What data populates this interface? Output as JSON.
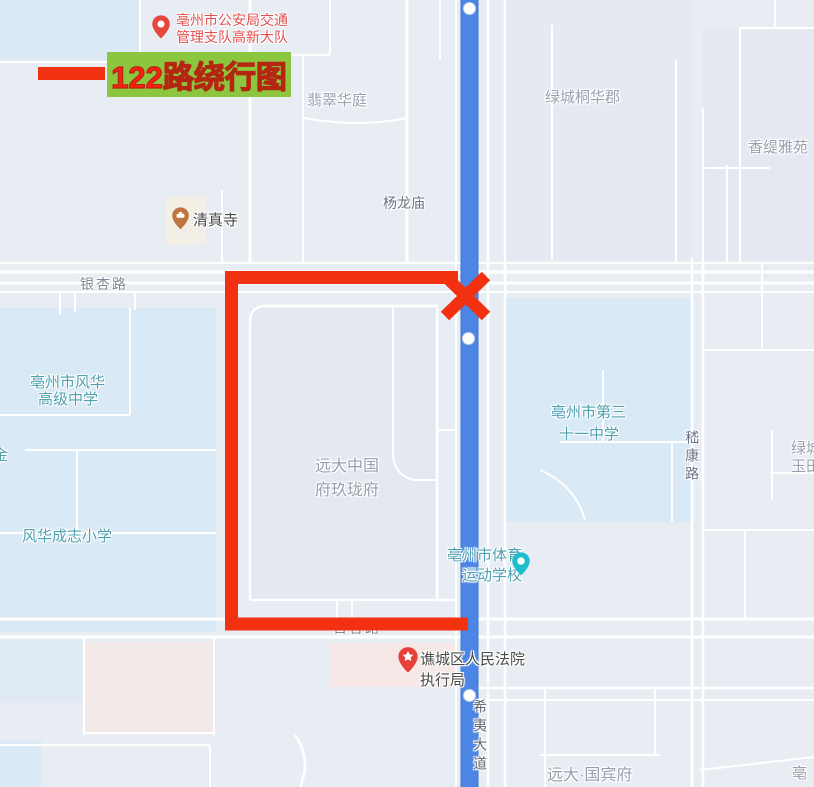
{
  "legend": {
    "title": "122路绕行图"
  },
  "pois": {
    "police": {
      "line1": "亳州市公安局交通",
      "line2": "管理支队高新大队"
    },
    "emerald_court": "翡翠华庭",
    "greentown_tonghua": "绿城桐华郡",
    "chanti_garden": "香缇雅苑",
    "yanglong_temple": "杨龙庙",
    "mosque": "清真寺",
    "fenghua_high": {
      "line1": "亳州市风华",
      "line2": "高级中学"
    },
    "jin_partial": "金",
    "chengzhi_primary": "风华成志小学",
    "yuanda_mansion": {
      "line1": "远大中国",
      "line2": "府玖珑府"
    },
    "no31_middle": {
      "line1": "亳州市第三",
      "line2": "十一中学"
    },
    "greentown_partial": {
      "line1": "绿城",
      "line2": "玉田"
    },
    "sports_school": {
      "line1": "亳州市体育",
      "line2": "运动学校"
    },
    "court": {
      "line1": "谯城区人民法院",
      "line2": "执行局"
    },
    "guobin_mansion": "远大·国宾府",
    "bozhou_partial": "亳"
  },
  "roads": {
    "yinxing": "银杏路",
    "baihe": "百合路",
    "jikang": "嵇康路",
    "xiyi": "希夷大道"
  },
  "colors": {
    "accent_red": "#f23110",
    "route_blue": "#4c86e4",
    "legend_green": "#8cc63f",
    "school_teal": "#4fa0b0",
    "poi_gray": "#99a1af"
  }
}
